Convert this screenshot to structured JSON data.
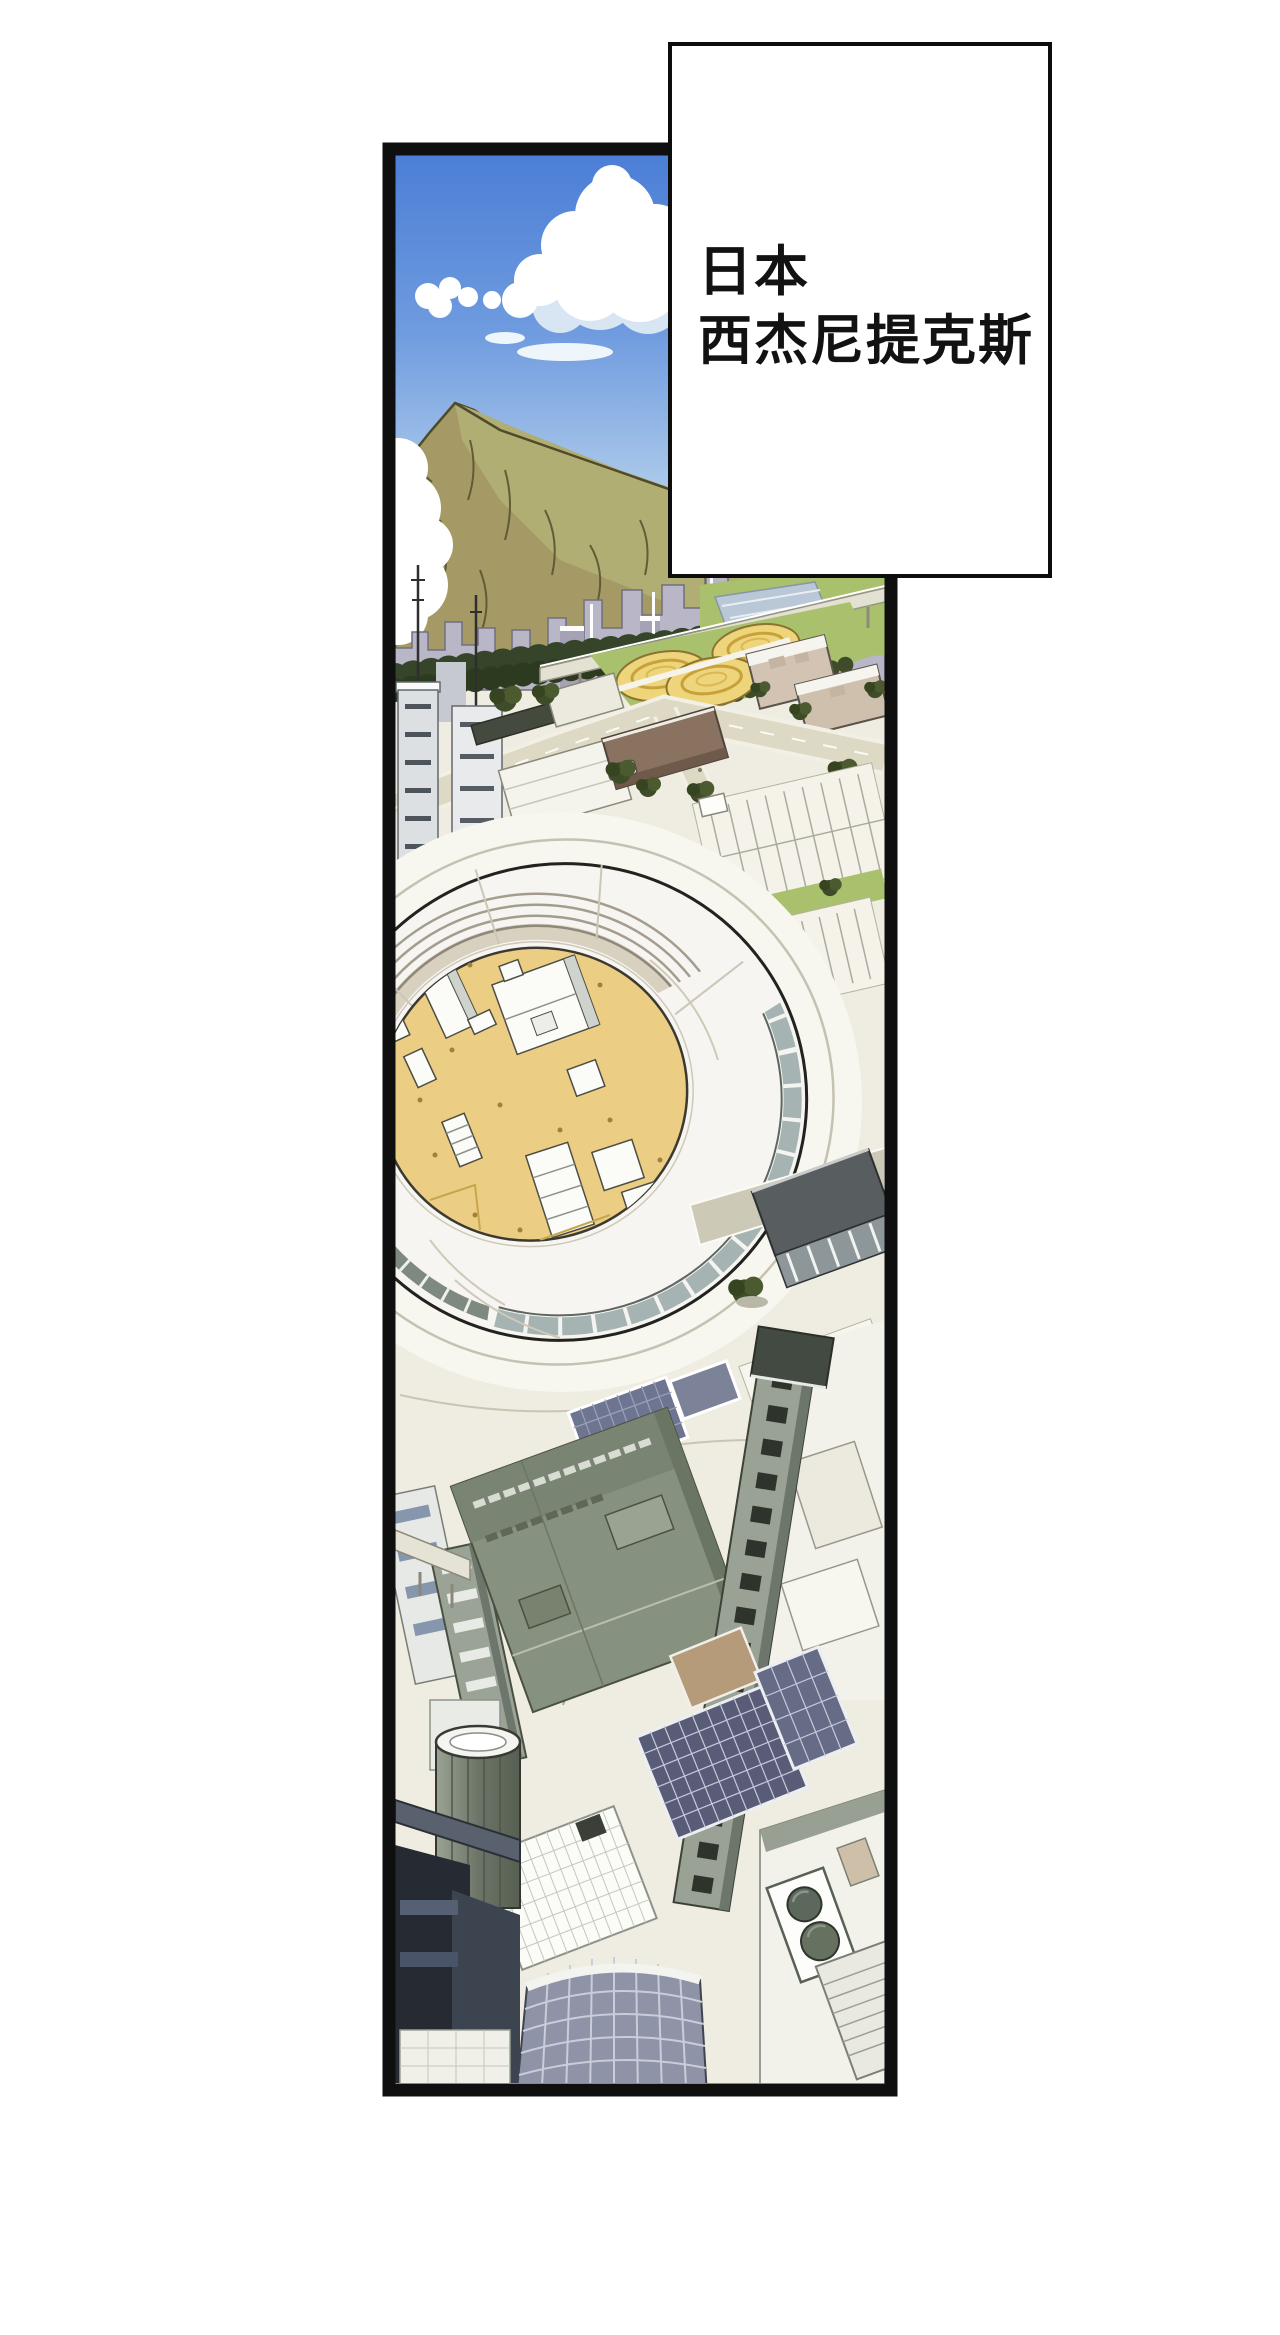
{
  "caption": {
    "lines": [
      "日本",
      "西杰尼提克斯"
    ]
  },
  "palette": {
    "panel_border": "#0f0f0f",
    "sky_top": "#4b7fd6",
    "sky_bottom": "#eef5fa",
    "cloud_white": "#ffffff",
    "mountain_dark_face": "#a59a66",
    "mountain_light_face": "#b0ae72",
    "distant_city": "#b9b6c7",
    "tree_dark_green": "#36452a",
    "lawn_green": "#a9c16c",
    "tank_yellow": "#eed47b",
    "courtyard_sand": "#eccd84",
    "ring_white": "#f6f5f1",
    "building_gray_green": "#87917f",
    "solar_panel_blue": "#585c77",
    "glass_tower_blue": "#8e93a7",
    "silhouette_dark": "#262b33",
    "ground": "#efede1",
    "road": "#ddd9c5"
  }
}
